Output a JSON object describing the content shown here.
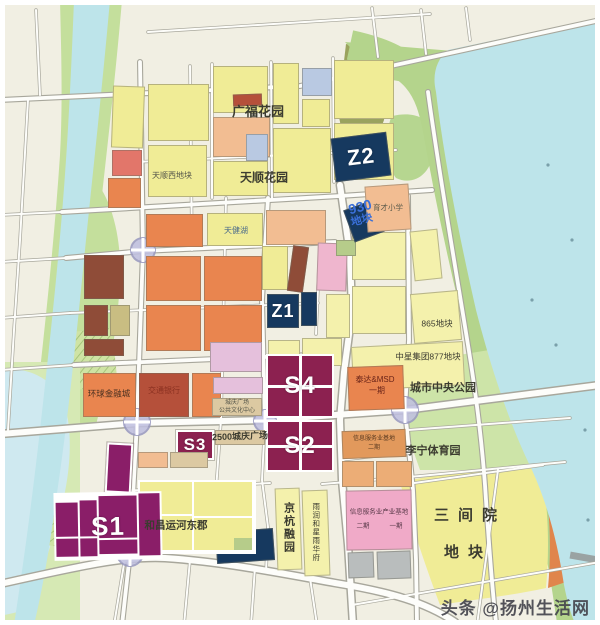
{
  "watermark": {
    "text": "头条 @扬州生活网"
  },
  "markers": {
    "z1": "Z1",
    "z2": "Z2",
    "z3": "Z3",
    "s1": "S1",
    "s2": "S2",
    "s3": "S3",
    "s4": "S4"
  },
  "labels": {
    "guangfu_garden": "广福花园",
    "tianshun_west_parcel": "天顺西地块",
    "tianshun_garden": "天顺花园",
    "tianjian_lake": "天健湖",
    "parcel_930_line1": "930",
    "parcel_930_line2": "地块",
    "yucai_school": "育才小学",
    "parcel_865": "865地块",
    "zhongxing_877": "中星集团877地块",
    "central_park": "城市中央公园",
    "lining_sports": "李宁体育园",
    "teda_msd": "泰达&MSD",
    "teda_msd_phase": "一期",
    "qing2500_plaza": "2500城庆广场",
    "culture_center_l1": "城庆广场",
    "culture_center_l2": "公共文化中心",
    "global_finance": "环球金融城",
    "bank": "交通银行",
    "hechang_estate": "和昌运河东郡",
    "jinghang_garden": "京杭融园",
    "yurun_estate": "雨润和星雨华府",
    "info_base_l1": "信息服务业基地",
    "info_base_l2": "二期",
    "info_industry": "信息服务业产业基地",
    "info_industry_p2": "二期",
    "info_industry_p1": "一期",
    "sanjianyuan": "三间院",
    "sanjianyuan_parcel": "地块"
  },
  "palette": {
    "water": "#bde4ea",
    "shore_green": "#b4d48c",
    "park_green": "#cde4a8",
    "residential_yellow": "#f0ec96",
    "commercial_orange": "#e9854f",
    "sale_maroon": "#8c2150",
    "sale_purple": "#8a1e68",
    "reserve_navy": "#16395f",
    "pink_industry": "#f0aac8",
    "road": "#fdfdfa",
    "label_blue": "#3a6fd8"
  }
}
